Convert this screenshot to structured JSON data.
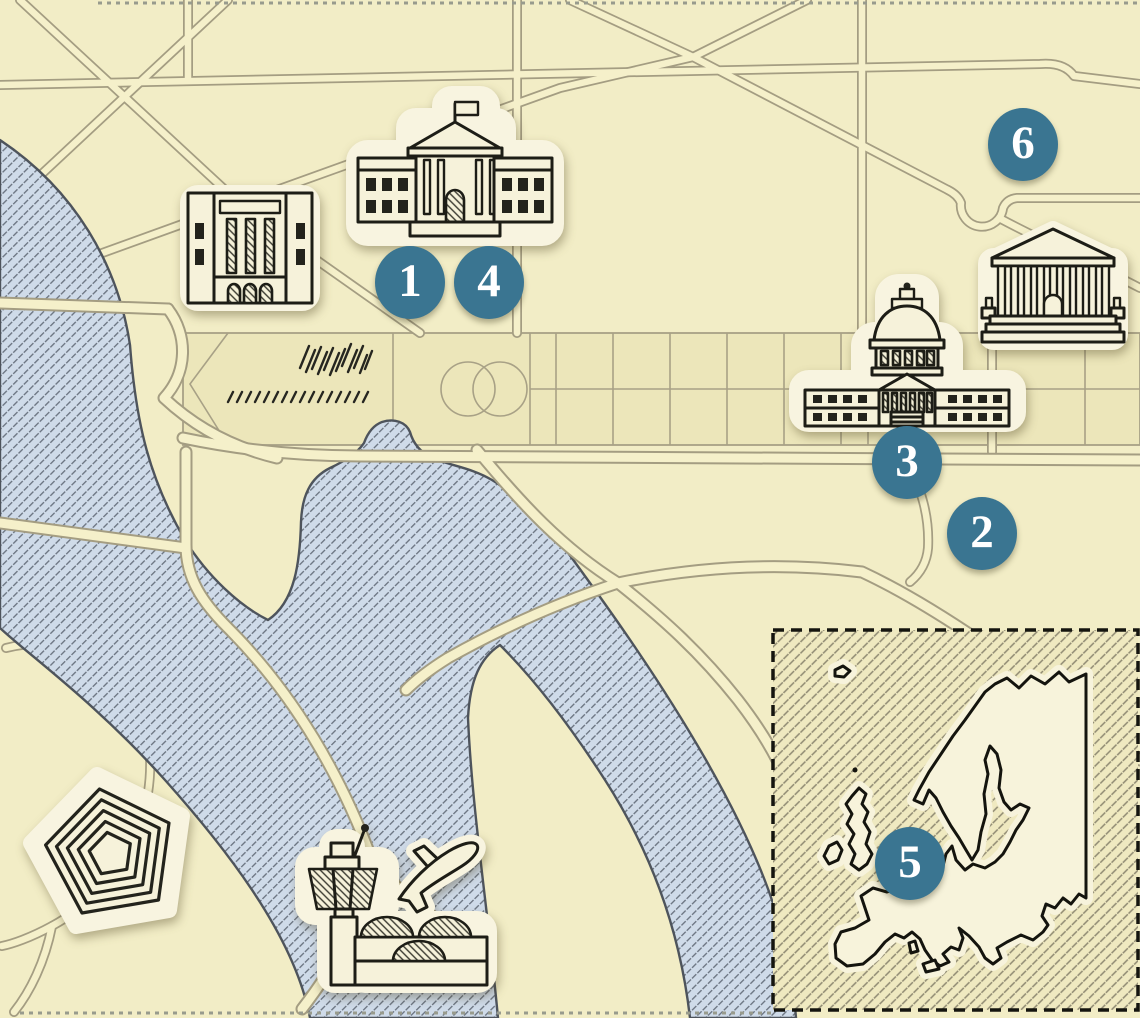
{
  "map": {
    "kind": "illustrated city map with numbered landmark markers and an inset map of Europe",
    "background_color": "#f2edc6",
    "water_color": "#cfdbe9",
    "road_fill_color": "#f5f0ca",
    "road_casing_color": "#a49d82",
    "marker_color": "#3a7591",
    "marker_text_color": "#ffffff",
    "markers": [
      {
        "label": "1",
        "x": 410,
        "y": 282
      },
      {
        "label": "2",
        "x": 982,
        "y": 533
      },
      {
        "label": "3",
        "x": 907,
        "y": 462
      },
      {
        "label": "4",
        "x": 489,
        "y": 282
      },
      {
        "label": "5",
        "x": 910,
        "y": 863
      },
      {
        "label": "6",
        "x": 1023,
        "y": 144
      }
    ],
    "icons": [
      {
        "name": "white-house-icon"
      },
      {
        "name": "classical-building-icon"
      },
      {
        "name": "capitol-icon"
      },
      {
        "name": "supreme-court-icon"
      },
      {
        "name": "pentagon-icon"
      },
      {
        "name": "airport-tower-icon"
      },
      {
        "name": "airplane-icon"
      },
      {
        "name": "europe-inset-map"
      }
    ]
  }
}
